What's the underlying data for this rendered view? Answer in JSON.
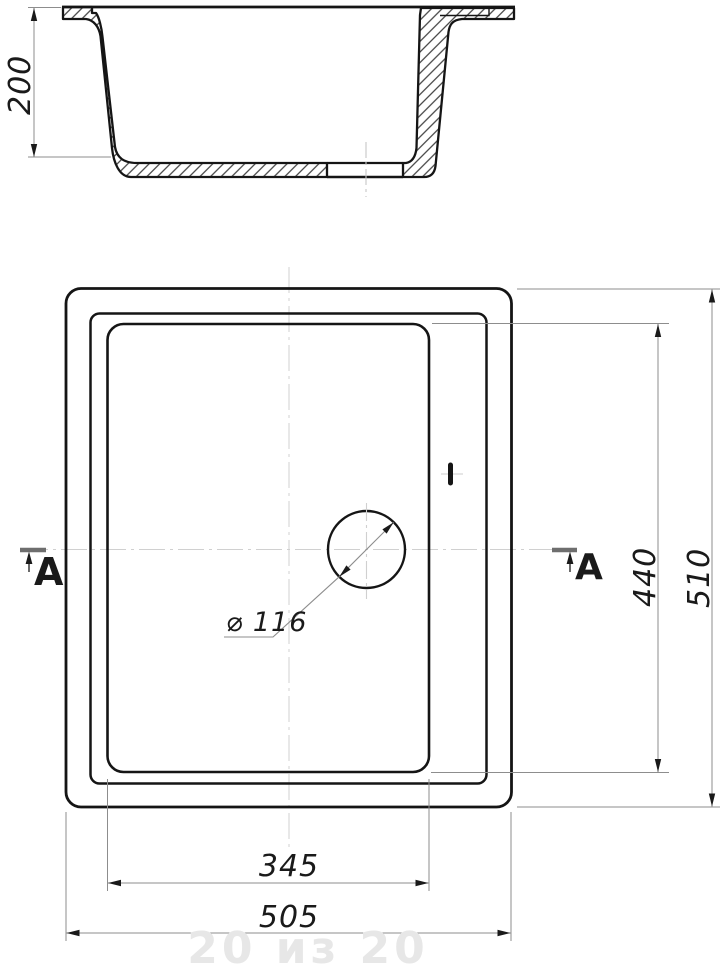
{
  "drawing": {
    "description": "Technical drawing of a kitchen sink: section profile (top) and plan view (bottom)",
    "section_view": {
      "depth_dim_label": "200"
    },
    "plan_view": {
      "outer_width_label": "505",
      "bowl_width_label": "345",
      "outer_length_label": "510",
      "bowl_length_label": "440",
      "drain_diameter_label": "⌀ 116",
      "section_marker_left": "A",
      "section_marker_right": "A"
    },
    "dimensions_mm": {
      "depth": 200,
      "outer_width": 505,
      "outer_length": 510,
      "bowl_width": 345,
      "bowl_length": 440,
      "drain_diameter": 116
    },
    "watermark": {
      "text": "20 из 20"
    },
    "colors": {
      "background": "#ffffff",
      "outline": "#151515",
      "thin_line": "#8d8d8d",
      "centerline": "#c6c6c6",
      "watermark": "#e7e7e7"
    }
  }
}
